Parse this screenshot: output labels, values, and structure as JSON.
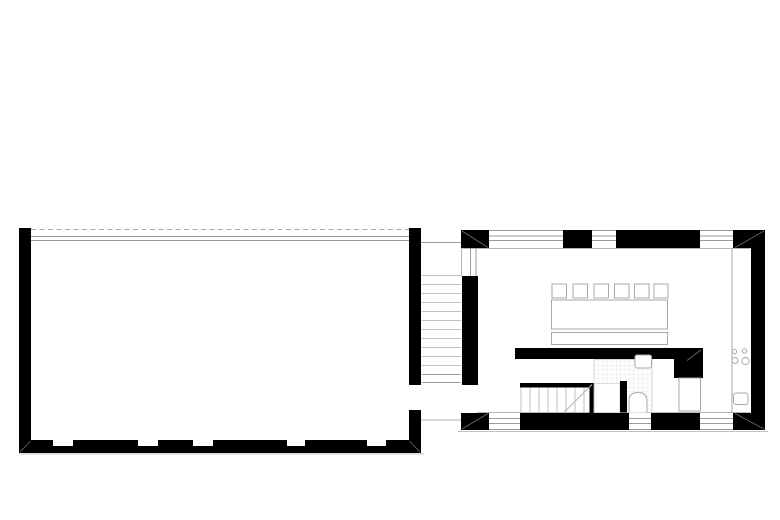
{
  "canvas": {
    "width": 780,
    "height": 520,
    "background": "#ffffff"
  },
  "palette": {
    "ink": "#000000",
    "wall_hairline": "#9c9c9c",
    "light_line": "#c2c2c2",
    "furniture_stroke": "#a8a8a8",
    "miter_line": "#6e6e6e",
    "tile_line": "#e3e3e3"
  },
  "floorplan": {
    "shapes": [
      {
        "t": "line",
        "name": "roof-dashed-line",
        "x1": 31,
        "y1": 229.5,
        "x2": 409,
        "y2": 229.5,
        "s": "#a8a8a8",
        "sw": 1,
        "da": "5 3.5"
      },
      {
        "t": "line",
        "name": "glass-facade-line-outer",
        "x1": 31,
        "y1": 236.5,
        "x2": 409,
        "y2": 236.5,
        "s": "#9c9c9c",
        "sw": 1
      },
      {
        "t": "line",
        "name": "glass-facade-line-inner",
        "x1": 31,
        "y1": 240.5,
        "x2": 409,
        "y2": 240.5,
        "s": "#9c9c9c",
        "sw": 1
      },
      {
        "t": "line",
        "name": "ground-line-left",
        "x1": 19,
        "y1": 454,
        "x2": 424,
        "y2": 454,
        "s": "#c2c2c2",
        "sw": 1
      },
      {
        "t": "rect",
        "name": "hall-west-wall",
        "x": 19,
        "y": 228,
        "w": 12,
        "h": 225,
        "f": "#000000"
      },
      {
        "t": "rect",
        "name": "hall-south-wall",
        "x": 19,
        "y": 440,
        "w": 402,
        "h": 13,
        "f": "#000000"
      },
      {
        "t": "rect",
        "name": "hall-south-window-notch-1",
        "x": 53,
        "y": 440,
        "w": 20,
        "h": 6,
        "f": "#ffffff"
      },
      {
        "t": "rect",
        "name": "hall-south-window-notch-2",
        "x": 138,
        "y": 440,
        "w": 20,
        "h": 6,
        "f": "#ffffff"
      },
      {
        "t": "rect",
        "name": "hall-south-window-notch-3",
        "x": 193,
        "y": 440,
        "w": 20,
        "h": 6,
        "f": "#ffffff"
      },
      {
        "t": "rect",
        "name": "hall-south-window-notch-4",
        "x": 287,
        "y": 440,
        "w": 18,
        "h": 6,
        "f": "#ffffff"
      },
      {
        "t": "rect",
        "name": "hall-south-window-notch-5",
        "x": 367,
        "y": 440,
        "w": 19,
        "h": 6,
        "f": "#ffffff"
      },
      {
        "t": "rect",
        "name": "hall-east-wall-upper",
        "x": 409,
        "y": 228,
        "w": 12,
        "h": 157,
        "f": "#000000"
      },
      {
        "t": "rect",
        "name": "hall-east-wall-lower",
        "x": 409,
        "y": 410,
        "w": 12,
        "h": 43,
        "f": "#000000"
      },
      {
        "t": "line",
        "name": "hall-sw-corner-miter",
        "x1": 20,
        "y1": 452,
        "x2": 30.5,
        "y2": 441,
        "s": "#6e6e6e",
        "sw": 0.8
      },
      {
        "t": "line",
        "name": "hall-se-corner-miter",
        "x1": 420,
        "y1": 452,
        "x2": 409.5,
        "y2": 441,
        "s": "#6e6e6e",
        "sw": 0.8
      },
      {
        "t": "line",
        "name": "stair-corridor-top-line",
        "x1": 421,
        "y1": 242.5,
        "x2": 461,
        "y2": 242.5,
        "s": "#9c9c9c",
        "sw": 1
      },
      {
        "t": "line",
        "name": "corridor-stair-step-1",
        "x1": 421.5,
        "y1": 275.5,
        "x2": 461,
        "y2": 275.5,
        "s": "#c2c2c2",
        "sw": 1
      },
      {
        "t": "line",
        "name": "corridor-stair-step-2",
        "x1": 421.5,
        "y1": 284.5,
        "x2": 461,
        "y2": 284.5,
        "s": "#c2c2c2",
        "sw": 1
      },
      {
        "t": "line",
        "name": "corridor-stair-step-3",
        "x1": 421.5,
        "y1": 293.5,
        "x2": 461,
        "y2": 293.5,
        "s": "#c2c2c2",
        "sw": 1
      },
      {
        "t": "line",
        "name": "corridor-stair-step-4",
        "x1": 421.5,
        "y1": 302.5,
        "x2": 461,
        "y2": 302.5,
        "s": "#c2c2c2",
        "sw": 1
      },
      {
        "t": "line",
        "name": "corridor-stair-step-5",
        "x1": 421.5,
        "y1": 311.5,
        "x2": 461,
        "y2": 311.5,
        "s": "#c2c2c2",
        "sw": 1
      },
      {
        "t": "line",
        "name": "corridor-stair-step-6",
        "x1": 421.5,
        "y1": 320.5,
        "x2": 461,
        "y2": 320.5,
        "s": "#c2c2c2",
        "sw": 1
      },
      {
        "t": "line",
        "name": "corridor-stair-step-7",
        "x1": 421.5,
        "y1": 329.5,
        "x2": 461,
        "y2": 329.5,
        "s": "#c2c2c2",
        "sw": 1
      },
      {
        "t": "line",
        "name": "corridor-stair-step-8",
        "x1": 421.5,
        "y1": 338.5,
        "x2": 461,
        "y2": 338.5,
        "s": "#c2c2c2",
        "sw": 1
      },
      {
        "t": "line",
        "name": "corridor-stair-step-9",
        "x1": 421.5,
        "y1": 347.5,
        "x2": 461,
        "y2": 347.5,
        "s": "#c2c2c2",
        "sw": 1
      },
      {
        "t": "line",
        "name": "corridor-stair-step-10",
        "x1": 421.5,
        "y1": 356.5,
        "x2": 461,
        "y2": 356.5,
        "s": "#c2c2c2",
        "sw": 1
      },
      {
        "t": "line",
        "name": "corridor-stair-step-11",
        "x1": 421.5,
        "y1": 365.5,
        "x2": 461,
        "y2": 365.5,
        "s": "#c2c2c2",
        "sw": 1
      },
      {
        "t": "line",
        "name": "corridor-stair-step-12",
        "x1": 421.5,
        "y1": 374.5,
        "x2": 461,
        "y2": 374.5,
        "s": "#9c9c9c",
        "sw": 1
      },
      {
        "t": "line",
        "name": "corridor-stair-step-13",
        "x1": 421.5,
        "y1": 382.5,
        "x2": 461,
        "y2": 382.5,
        "s": "#9c9c9c",
        "sw": 1
      },
      {
        "t": "line",
        "name": "corridor-south-line",
        "x1": 421,
        "y1": 420,
        "x2": 461,
        "y2": 420,
        "s": "#b4b4b4",
        "sw": 1
      },
      {
        "t": "line",
        "name": "north-wall-outer-edge",
        "x1": 461,
        "y1": 230.5,
        "x2": 765,
        "y2": 230.5,
        "s": "#9c9c9c",
        "sw": 1
      },
      {
        "t": "line",
        "name": "north-window-glazing-outer",
        "x1": 461,
        "y1": 236,
        "x2": 765,
        "y2": 236,
        "s": "#9c9c9c",
        "sw": 1
      },
      {
        "t": "line",
        "name": "north-window-glazing-inner",
        "x1": 461,
        "y1": 240.5,
        "x2": 765,
        "y2": 240.5,
        "s": "#9c9c9c",
        "sw": 1
      },
      {
        "t": "line",
        "name": "north-wall-inner-edge",
        "x1": 461,
        "y1": 248.5,
        "x2": 750,
        "y2": 248.5,
        "s": "#b4b4b4",
        "sw": 1
      },
      {
        "t": "line",
        "name": "south-wall-inner-edge",
        "x1": 477,
        "y1": 412.5,
        "x2": 750,
        "y2": 412.5,
        "s": "#b4b4b4",
        "sw": 1
      },
      {
        "t": "line",
        "name": "south-window-glazing-outer",
        "x1": 461,
        "y1": 418.5,
        "x2": 765,
        "y2": 418.5,
        "s": "#9c9c9c",
        "sw": 1
      },
      {
        "t": "line",
        "name": "south-window-glazing-inner",
        "x1": 461,
        "y1": 423.5,
        "x2": 765,
        "y2": 423.5,
        "s": "#9c9c9c",
        "sw": 1
      },
      {
        "t": "line",
        "name": "south-wall-outer-edge",
        "x1": 461,
        "y1": 429.5,
        "x2": 765,
        "y2": 429.5,
        "s": "#9c9c9c",
        "sw": 1
      },
      {
        "t": "line",
        "name": "ground-line-right",
        "x1": 458,
        "y1": 431.5,
        "x2": 768,
        "y2": 431.5,
        "s": "#c2c2c2",
        "sw": 1
      },
      {
        "t": "rect",
        "name": "nw-corner-pier",
        "x": 461,
        "y": 230,
        "w": 28,
        "h": 18,
        "f": "#000000"
      },
      {
        "t": "rect",
        "name": "north-wall-pier-mid",
        "x": 563,
        "y": 230,
        "w": 29,
        "h": 18,
        "f": "#000000"
      },
      {
        "t": "rect",
        "name": "north-wall-segment-east",
        "x": 616,
        "y": 230,
        "w": 84,
        "h": 18,
        "f": "#000000"
      },
      {
        "t": "rect",
        "name": "ne-corner-pier",
        "x": 733,
        "y": 230,
        "w": 32,
        "h": 18,
        "f": "#000000"
      },
      {
        "t": "rect",
        "name": "east-wall",
        "x": 751,
        "y": 230,
        "w": 14,
        "h": 200,
        "f": "#000000"
      },
      {
        "t": "rect",
        "name": "west-wall",
        "x": 462,
        "y": 276,
        "w": 16,
        "h": 109,
        "f": "#000000"
      },
      {
        "t": "rect",
        "name": "sw-corner-pier",
        "x": 461,
        "y": 413,
        "w": 28,
        "h": 17,
        "f": "#000000"
      },
      {
        "t": "rect",
        "name": "south-wall-segment-mid",
        "x": 520,
        "y": 413,
        "w": 109,
        "h": 17,
        "f": "#000000"
      },
      {
        "t": "rect",
        "name": "south-wall-segment-east",
        "x": 651,
        "y": 413,
        "w": 49,
        "h": 17,
        "f": "#000000"
      },
      {
        "t": "rect",
        "name": "se-corner-pier",
        "x": 733,
        "y": 413,
        "w": 32,
        "h": 17,
        "f": "#000000"
      },
      {
        "t": "line",
        "name": "west-window-glazing-outer",
        "x1": 470.5,
        "y1": 248,
        "x2": 470.5,
        "y2": 276,
        "s": "#9c9c9c",
        "sw": 1
      },
      {
        "t": "line",
        "name": "west-window-glazing-inner",
        "x1": 476,
        "y1": 248,
        "x2": 476,
        "y2": 276,
        "s": "#9c9c9c",
        "sw": 1
      },
      {
        "t": "line",
        "name": "west-wall-outer-edge",
        "x1": 461.5,
        "y1": 248,
        "x2": 461.5,
        "y2": 276,
        "s": "#b4b4b4",
        "sw": 1
      },
      {
        "t": "line",
        "name": "nw-corner-miter",
        "x1": 462,
        "y1": 231,
        "x2": 488,
        "y2": 247.5,
        "s": "#6e6e6e",
        "sw": 0.8
      },
      {
        "t": "line",
        "name": "ne-corner-miter",
        "x1": 764,
        "y1": 231,
        "x2": 735,
        "y2": 247.5,
        "s": "#6e6e6e",
        "sw": 0.8
      },
      {
        "t": "line",
        "name": "sw-corner-miter",
        "x1": 462,
        "y1": 429,
        "x2": 488,
        "y2": 413.5,
        "s": "#6e6e6e",
        "sw": 0.8
      },
      {
        "t": "line",
        "name": "se-corner-miter",
        "x1": 764,
        "y1": 429,
        "x2": 735,
        "y2": 413.5,
        "s": "#6e6e6e",
        "sw": 0.8
      },
      {
        "t": "line",
        "name": "kitchen-counter-edge",
        "x1": 732,
        "y1": 248.5,
        "x2": 732,
        "y2": 412.5,
        "s": "#a8a8a8",
        "sw": 1
      },
      {
        "t": "circle",
        "name": "cooktop-burner-small-1",
        "cx": 734.5,
        "cy": 351.5,
        "r": 2.2,
        "f": "#ffffff",
        "s": "#a8a8a8",
        "sw": 1
      },
      {
        "t": "circle",
        "name": "cooktop-burner-small-2",
        "cx": 744.5,
        "cy": 351,
        "r": 2.2,
        "f": "#ffffff",
        "s": "#a8a8a8",
        "sw": 1
      },
      {
        "t": "circle",
        "name": "cooktop-burner-large-1",
        "cx": 735,
        "cy": 360.5,
        "r": 3,
        "f": "#ffffff",
        "s": "#a8a8a8",
        "sw": 1
      },
      {
        "t": "circle",
        "name": "cooktop-burner-large-2",
        "cx": 745.5,
        "cy": 361,
        "r": 3.6,
        "f": "#ffffff",
        "s": "#a8a8a8",
        "sw": 1
      },
      {
        "t": "rect",
        "name": "kitchen-sink",
        "x": 733.5,
        "y": 393,
        "w": 14.5,
        "h": 11.5,
        "rx": 2.5,
        "f": "#ffffff",
        "s": "#a8a8a8",
        "sw": 1
      },
      {
        "t": "rect",
        "name": "dining-table",
        "x": 551.5,
        "y": 300,
        "w": 116,
        "h": 29,
        "f": "#ffffff",
        "s": "#a8a8a8",
        "sw": 1
      },
      {
        "t": "rect",
        "name": "bench",
        "x": 551.5,
        "y": 332.5,
        "w": 116,
        "h": 12,
        "f": "#ffffff",
        "s": "#a8a8a8",
        "sw": 1
      },
      {
        "t": "rect",
        "name": "chair-1",
        "x": 552,
        "y": 284,
        "w": 14.5,
        "h": 14,
        "f": "#ffffff",
        "s": "#a8a8a8",
        "sw": 1
      },
      {
        "t": "rect",
        "name": "chair-2",
        "x": 573,
        "y": 284,
        "w": 14.5,
        "h": 14,
        "f": "#ffffff",
        "s": "#a8a8a8",
        "sw": 1
      },
      {
        "t": "rect",
        "name": "chair-3",
        "x": 594,
        "y": 284,
        "w": 14.5,
        "h": 14,
        "f": "#ffffff",
        "s": "#a8a8a8",
        "sw": 1
      },
      {
        "t": "rect",
        "name": "chair-4",
        "x": 614.5,
        "y": 284,
        "w": 14.5,
        "h": 14,
        "f": "#ffffff",
        "s": "#a8a8a8",
        "sw": 1
      },
      {
        "t": "rect",
        "name": "chair-5",
        "x": 634.5,
        "y": 284,
        "w": 14.5,
        "h": 14,
        "f": "#ffffff",
        "s": "#a8a8a8",
        "sw": 1
      },
      {
        "t": "rect",
        "name": "chair-6",
        "x": 654,
        "y": 284,
        "w": 14,
        "h": 14,
        "f": "#ffffff",
        "s": "#a8a8a8",
        "sw": 1
      },
      {
        "t": "rect",
        "name": "interior-wall-horizontal",
        "x": 515,
        "y": 348,
        "w": 188,
        "h": 11,
        "f": "#000000"
      },
      {
        "t": "rect",
        "name": "interior-wall-vertical",
        "x": 674,
        "y": 359,
        "w": 29,
        "h": 19,
        "f": "#000000"
      },
      {
        "t": "line",
        "name": "interior-wall-corner-miter",
        "x1": 701,
        "y1": 350,
        "x2": 687,
        "y2": 360.5,
        "s": "#6e6e6e",
        "sw": 0.8
      },
      {
        "t": "rect",
        "name": "cupboard",
        "x": 679,
        "y": 378,
        "w": 21.5,
        "h": 33,
        "f": "#ffffff",
        "s": "#a8a8a8",
        "sw": 1
      },
      {
        "t": "rect",
        "name": "stair-top-wall",
        "x": 520,
        "y": 383,
        "w": 74.5,
        "h": 4.5,
        "f": "#000000"
      },
      {
        "t": "rect",
        "name": "stair-side-wall",
        "x": 589.5,
        "y": 383,
        "w": 5,
        "h": 30,
        "f": "#000000"
      },
      {
        "t": "line",
        "name": "stair-left-edge",
        "x1": 521,
        "y1": 387.5,
        "x2": 521,
        "y2": 412.5,
        "s": "#c2c2c2",
        "sw": 1
      },
      {
        "t": "line",
        "name": "interior-stair-step-1",
        "x1": 530,
        "y1": 387.5,
        "x2": 530,
        "y2": 412.5,
        "s": "#c2c2c2",
        "sw": 1
      },
      {
        "t": "line",
        "name": "interior-stair-step-2",
        "x1": 539,
        "y1": 387.5,
        "x2": 539,
        "y2": 412.5,
        "s": "#c2c2c2",
        "sw": 1
      },
      {
        "t": "line",
        "name": "interior-stair-step-3",
        "x1": 548,
        "y1": 387.5,
        "x2": 548,
        "y2": 412.5,
        "s": "#c2c2c2",
        "sw": 1
      },
      {
        "t": "line",
        "name": "interior-stair-step-4",
        "x1": 557,
        "y1": 387.5,
        "x2": 557,
        "y2": 412.5,
        "s": "#c2c2c2",
        "sw": 1
      },
      {
        "t": "line",
        "name": "interior-stair-step-5",
        "x1": 566,
        "y1": 387.5,
        "x2": 566,
        "y2": 412.5,
        "s": "#c2c2c2",
        "sw": 1
      },
      {
        "t": "line",
        "name": "interior-stair-step-6",
        "x1": 575,
        "y1": 387.5,
        "x2": 575,
        "y2": 412.5,
        "s": "#c2c2c2",
        "sw": 1
      },
      {
        "t": "line",
        "name": "interior-stair-step-7",
        "x1": 584,
        "y1": 387.5,
        "x2": 584,
        "y2": 412.5,
        "s": "#c2c2c2",
        "sw": 1
      },
      {
        "t": "line",
        "name": "stair-direction-line",
        "x1": 564,
        "y1": 412.5,
        "x2": 592,
        "y2": 384.5,
        "s": "#b4b4b4",
        "sw": 1
      },
      {
        "t": "rect",
        "name": "bathroom-tiled-floor",
        "x": 594,
        "y": 359.5,
        "w": 58,
        "h": 53,
        "f": "tiles",
        "s": "#cfcfcf",
        "sw": 0.8
      },
      {
        "t": "rect",
        "name": "shower-area",
        "x": 594.5,
        "y": 383.5,
        "w": 25.5,
        "h": 29,
        "f": "#ffffff",
        "s": "#d6d6d6",
        "sw": 0.8
      },
      {
        "t": "rect",
        "name": "bathroom-partition-wall",
        "x": 620,
        "y": 381,
        "w": 7,
        "h": 31.5,
        "f": "#000000"
      },
      {
        "t": "path",
        "name": "toilet",
        "p": "M629,412.5 L629,401 Q629,392.5 638,392.5 Q647,392.5 647,401 L647,412.5",
        "f": "#ffffff",
        "s": "#a8a8a8",
        "sw": 1
      },
      {
        "t": "rect",
        "name": "bathroom-sink",
        "x": 635,
        "y": 355,
        "w": 16.5,
        "h": 13,
        "rx": 2,
        "f": "#ffffff",
        "s": "#a8a8a8",
        "sw": 1
      }
    ]
  }
}
